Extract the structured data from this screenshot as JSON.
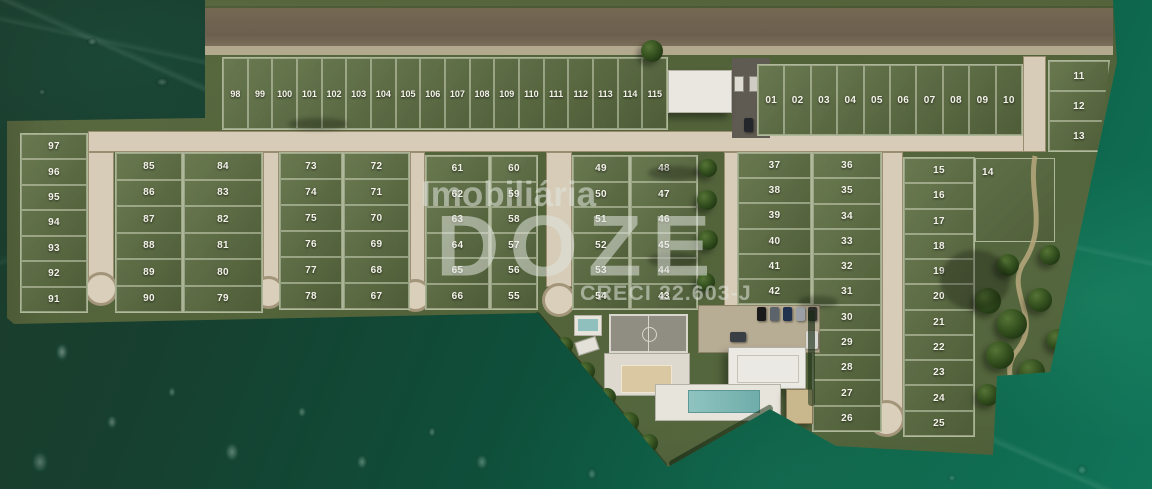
{
  "watermark": {
    "brand_top": "Imobiliária",
    "brand_main": "DOZE",
    "creci": "CRECI 22.603-J"
  },
  "blocks": {
    "row_98_115": [
      "98",
      "99",
      "100",
      "101",
      "102",
      "103",
      "104",
      "105",
      "106",
      "107",
      "108",
      "109",
      "110",
      "111",
      "112",
      "113",
      "114",
      "115"
    ],
    "row_01_10": [
      "01",
      "02",
      "03",
      "04",
      "05",
      "06",
      "07",
      "08",
      "09",
      "10"
    ],
    "col_11_13": [
      "11",
      "12",
      "13"
    ],
    "col_97_91": [
      "97",
      "96",
      "95",
      "94",
      "93",
      "92",
      "91"
    ],
    "block_a_left": [
      "85",
      "86",
      "87",
      "88",
      "89",
      "90"
    ],
    "block_a_right": [
      "84",
      "83",
      "82",
      "81",
      "80",
      "79"
    ],
    "block_b_left": [
      "73",
      "74",
      "75",
      "76",
      "77",
      "78"
    ],
    "block_b_right": [
      "72",
      "71",
      "70",
      "69",
      "68",
      "67"
    ],
    "block_c_left": [
      "61",
      "62",
      "63",
      "64",
      "65",
      "66"
    ],
    "block_c_right": [
      "60",
      "59",
      "58",
      "57",
      "56",
      "55"
    ],
    "block_d_left": [
      "49",
      "50",
      "51",
      "52",
      "53",
      "54"
    ],
    "block_d_right": [
      "48",
      "47",
      "46",
      "45",
      "44",
      "43"
    ],
    "block_e_left": [
      "37",
      "38",
      "39",
      "40",
      "41",
      "42"
    ],
    "block_e_right": [
      "36",
      "35",
      "34",
      "33",
      "32",
      "31",
      "30",
      "29",
      "28",
      "27",
      "26"
    ],
    "col_15_25": [
      "15",
      "16",
      "17",
      "18",
      "19",
      "20",
      "21",
      "22",
      "23",
      "24",
      "25"
    ],
    "lot_14_label": "14"
  },
  "colors": {
    "leaf_background": "#0c5740",
    "plat_green": "#55673e",
    "road_tan": "#d6ccb7",
    "road_brown": "#6b5f4e",
    "pool_teal": "#7cb6b3",
    "sand_court": "#d9c8a1",
    "watermark_white": "#e2e5df"
  }
}
